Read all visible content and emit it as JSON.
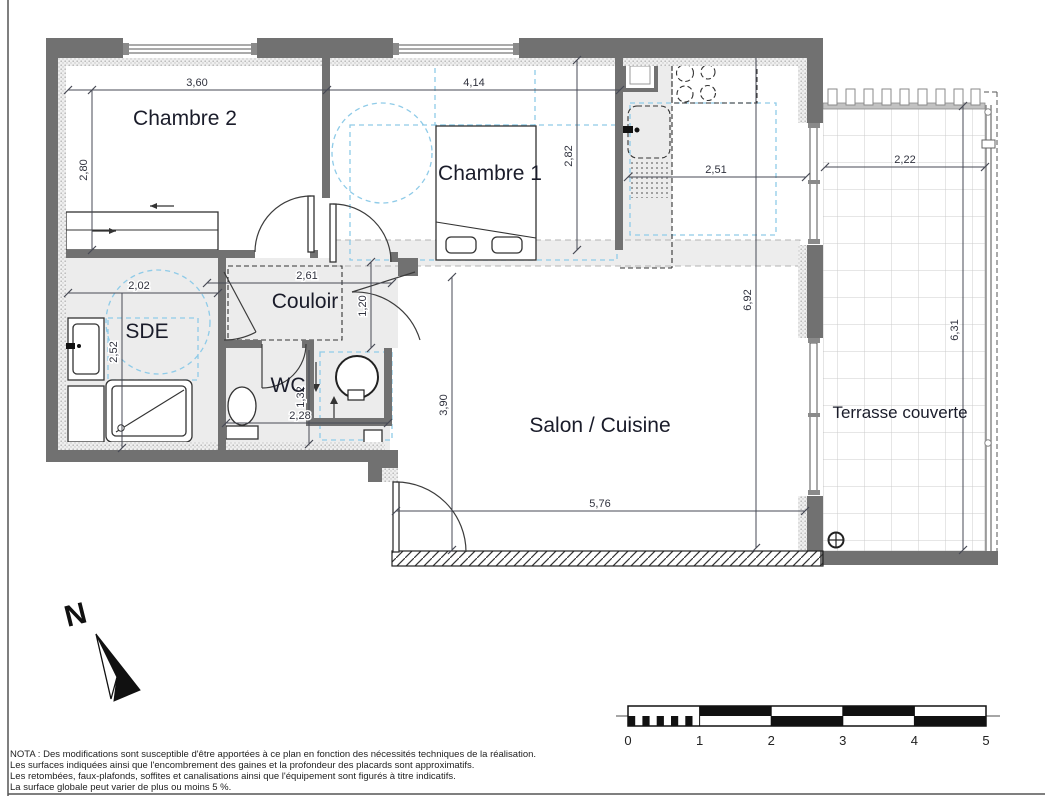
{
  "plan": {
    "rooms": {
      "chambre2": "Chambre 2",
      "chambre1": "Chambre 1",
      "couloir": "Couloir",
      "sde": "SDE",
      "wc": "WC",
      "salon_cuisine": "Salon / Cuisine",
      "terrasse": "Terrasse couverte"
    },
    "dimensions": {
      "chambre2_width": "3,60",
      "chambre2_depth": "2,80",
      "chambre1_width": "4,14",
      "chambre1_depth": "2,82",
      "cuisine_width": "2,51",
      "terrasse_width": "2,22",
      "terrasse_depth": "6,31",
      "salon_depth_right": "6,92",
      "couloir_width": "2,61",
      "couloir_depth": "1,20",
      "sde_width": "2,02",
      "sde_depth": "2,52",
      "wc_depth": "1,32",
      "wc_width": "2,28",
      "salon_depth_left": "3,90",
      "salon_width": "5,76"
    },
    "north_label": "N",
    "scale_bar": {
      "ticks": [
        "0",
        "1",
        "2",
        "3",
        "4",
        "5"
      ]
    },
    "nota_lines": [
      "NOTA : Des modifications sont susceptible d'être apportées à ce plan en fonction des nécessités techniques de la réalisation.",
      "Les surfaces indiquées ainsi que l'encombrement des gaines et la profondeur des placards sont approximatifs.",
      "Les retombées, faux-plafonds, soffites et canalisations ainsi que l'équipement sont figurés à titre indicatifs.",
      "La surface globale peut varier de plus ou moins 5 %."
    ],
    "colors": {
      "wall": "#717171",
      "clearance_dash": "#8fcbe8",
      "room_fill": "#ececec"
    }
  }
}
